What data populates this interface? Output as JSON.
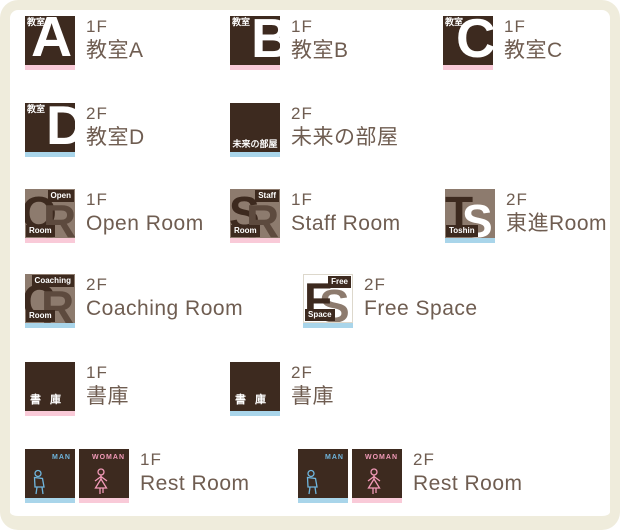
{
  "page": {
    "background": "#ffffff",
    "frame_color": "#efecdc"
  },
  "colors": {
    "dark_brown": "#3d2a1f",
    "taupe": "#8d7b6e",
    "text_brown": "#6f5d51",
    "strip_pink_1f": "#f9cad8",
    "strip_blue_2f": "#a9d5ea",
    "man_blue": "#6fb5dd",
    "woman_pink": "#f29ab8"
  },
  "items": [
    {
      "floor": "1F",
      "label": "教室A",
      "icon": {
        "tag": "教室",
        "letter": "A"
      }
    },
    {
      "floor": "1F",
      "label": "教室B",
      "icon": {
        "tag": "教室",
        "letter": "B"
      }
    },
    {
      "floor": "1F",
      "label": "教室C",
      "icon": {
        "tag": "教室",
        "letter": "C"
      }
    },
    {
      "floor": "2F",
      "label": "教室D",
      "icon": {
        "tag": "教室",
        "letter": "D"
      }
    },
    {
      "floor": "2F",
      "label": "未来の部屋",
      "icon": {
        "text": "未来の部屋"
      }
    },
    {
      "floor": "1F",
      "label": "Open Room",
      "icon": {
        "letter1": "O",
        "letter2": "R",
        "badge_top": "Open",
        "badge_bottom": "Room"
      }
    },
    {
      "floor": "1F",
      "label": "Staff Room",
      "icon": {
        "letter1": "S",
        "letter2": "R",
        "badge_top": "Staff",
        "badge_bottom": "Room"
      }
    },
    {
      "floor": "2F",
      "label": "東進Room",
      "icon": {
        "letter1": "T",
        "letter2": "S",
        "badge_bottom": "Toshin"
      }
    },
    {
      "floor": "2F",
      "label": "Coaching Room",
      "icon": {
        "letter1": "C",
        "letter2": "R",
        "badge_top": "Coaching",
        "badge_bottom": "Room"
      }
    },
    {
      "floor": "2F",
      "label": "Free Space",
      "icon": {
        "letter1": "F",
        "letter2": "S",
        "badge_top": "Free",
        "badge_bottom": "Space"
      }
    },
    {
      "floor": "1F",
      "label": "書庫",
      "icon": {
        "text": "書 庫"
      }
    },
    {
      "floor": "2F",
      "label": "書庫",
      "icon": {
        "text": "書 庫"
      }
    },
    {
      "floor": "1F",
      "label": "Rest Room",
      "icon": {
        "man": "MAN",
        "woman": "WOMAN"
      }
    },
    {
      "floor": "2F",
      "label": "Rest Room",
      "icon": {
        "man": "MAN",
        "woman": "WOMAN"
      }
    }
  ]
}
